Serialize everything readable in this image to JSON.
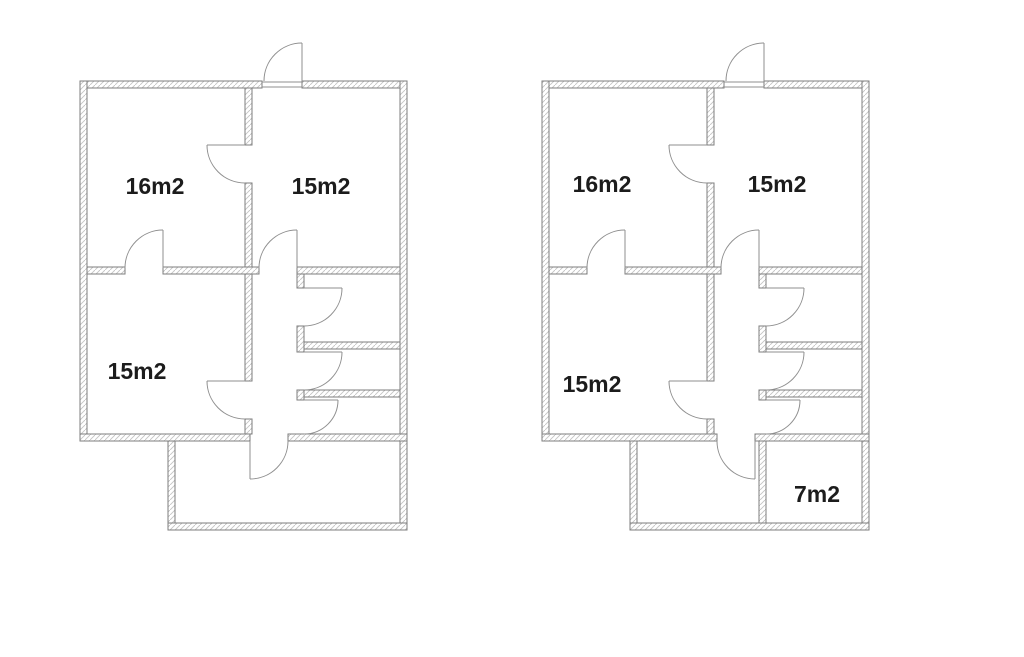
{
  "canvas": {
    "background": "#ffffff"
  },
  "colors": {
    "wall_outline": "#7d7d7d",
    "wall_hatch": "#c4c4c4",
    "door_stroke": "#8f8f8f",
    "label_text": "#1c1c1c"
  },
  "plans": [
    {
      "id": "floor-plan-left",
      "rooms": [
        {
          "name": "room-top-left",
          "label": "16m2"
        },
        {
          "name": "room-top-right",
          "label": "15m2"
        },
        {
          "name": "room-middle-left",
          "label": "15m2"
        }
      ]
    },
    {
      "id": "floor-plan-right",
      "rooms": [
        {
          "name": "room-top-left",
          "label": "16m2"
        },
        {
          "name": "room-top-right",
          "label": "15m2"
        },
        {
          "name": "room-middle-left",
          "label": "15m2"
        },
        {
          "name": "room-bottom-right",
          "label": "7m2"
        }
      ]
    }
  ]
}
